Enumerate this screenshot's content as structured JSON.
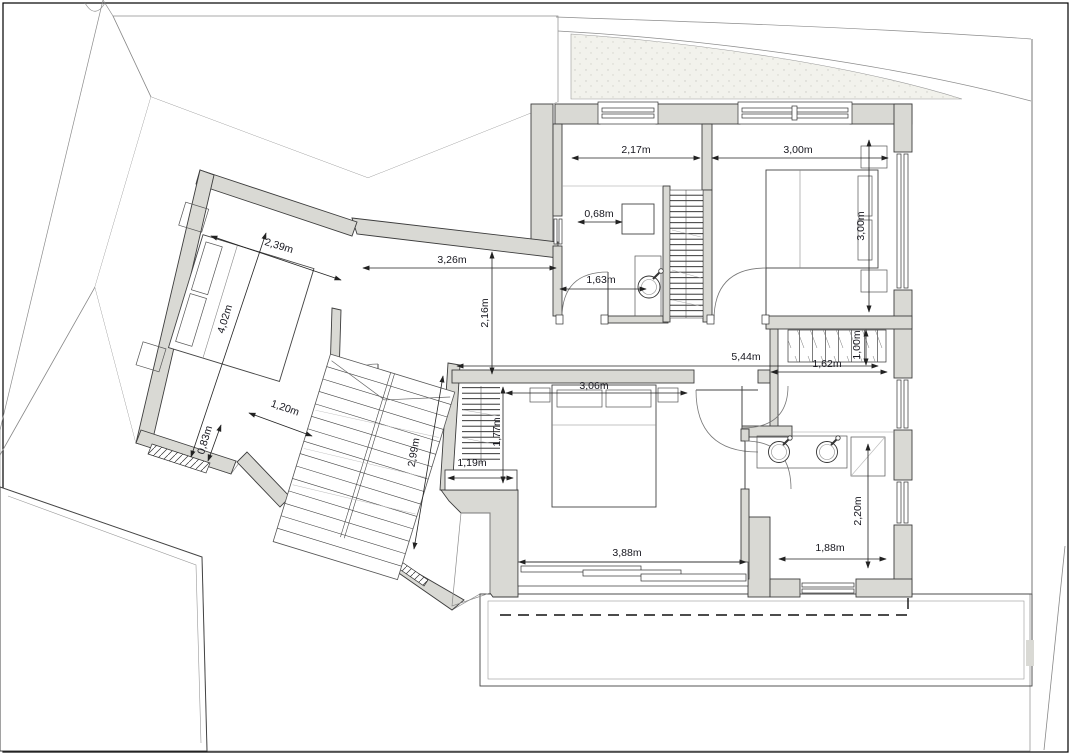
{
  "plan": {
    "title": "first-floor-plan",
    "units": "m",
    "colors": {
      "wall_fill": "#d9d9d4",
      "wall_stroke": "#3d3d3d",
      "terrain_line": "#c2c2c2",
      "boundary": "#8c8c8c",
      "dim_text": "#16161e",
      "paper": "#ffffff"
    },
    "dimensions": [
      {
        "id": "room-top-width",
        "label": "2,17m",
        "x": 636,
        "y": 153,
        "rot": 0
      },
      {
        "id": "bedroom-right-width",
        "label": "3,00m",
        "x": 798,
        "y": 153,
        "rot": 0
      },
      {
        "id": "bedroom-right-depth",
        "label": "3,00m",
        "x": 864,
        "y": 226,
        "rot": -90
      },
      {
        "id": "desk-width",
        "label": "0,68m",
        "x": 599,
        "y": 217,
        "rot": 0
      },
      {
        "id": "sink-room-width",
        "label": "1,63m",
        "x": 601,
        "y": 283,
        "rot": 0
      },
      {
        "id": "hall-width",
        "label": "3,26m",
        "x": 452,
        "y": 263,
        "rot": 0
      },
      {
        "id": "hall-depth",
        "label": "2,16m",
        "x": 488,
        "y": 313,
        "rot": -90
      },
      {
        "id": "corridor-length",
        "label": "5,44m",
        "x": 746,
        "y": 360,
        "rot": 0
      },
      {
        "id": "hall-gap",
        "label": "1,00m",
        "x": 860,
        "y": 345,
        "rot": -90
      },
      {
        "id": "master-bed-width",
        "label": "3,06m",
        "x": 594,
        "y": 389,
        "rot": 0
      },
      {
        "id": "closet-width",
        "label": "1,62m",
        "x": 827,
        "y": 367,
        "rot": 0
      },
      {
        "id": "wing-room-width",
        "label": "2,39m",
        "x": 278,
        "y": 249,
        "rot": 17
      },
      {
        "id": "wing-room-length",
        "label": "4,02m",
        "x": 228,
        "y": 320,
        "rot": -73
      },
      {
        "id": "wing-recess-width",
        "label": "1,20m",
        "x": 284,
        "y": 411,
        "rot": 19
      },
      {
        "id": "wing-recess-depth",
        "label": "0,83m",
        "x": 208,
        "y": 441,
        "rot": -73
      },
      {
        "id": "stairs-length",
        "label": "2,99m",
        "x": 417,
        "y": 453,
        "rot": -80
      },
      {
        "id": "shelf-depth",
        "label": "1,77m",
        "x": 500,
        "y": 432,
        "rot": -90
      },
      {
        "id": "cabinet-width",
        "label": "1,19m",
        "x": 472,
        "y": 466,
        "rot": 0
      },
      {
        "id": "master-window-width",
        "label": "3,88m",
        "x": 627,
        "y": 556,
        "rot": 0
      },
      {
        "id": "bath-width",
        "label": "1,88m",
        "x": 830,
        "y": 551,
        "rot": 0
      },
      {
        "id": "bath-depth",
        "label": "2,20m",
        "x": 861,
        "y": 511,
        "rot": -90
      }
    ]
  }
}
